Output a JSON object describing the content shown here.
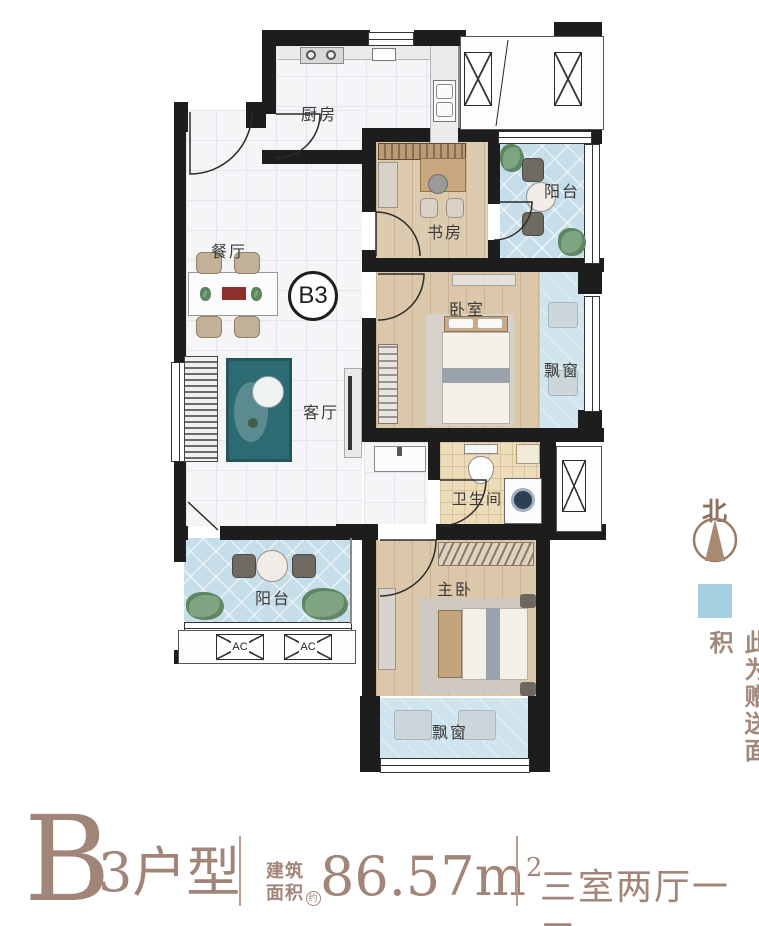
{
  "plan": {
    "badge_label": "B3",
    "labels": {
      "kitchen": "厨房",
      "dining": "餐厅",
      "living": "客厅",
      "study": "书房",
      "balcony_top": "阳台",
      "balcony_bottom": "阳台",
      "bedroom": "卧室",
      "bay_window_right": "飘窗",
      "bay_window_bottom": "飘窗",
      "bathroom": "卫生间",
      "master_bedroom": "主卧",
      "ac": "AC"
    },
    "legend": {
      "north_label": "北",
      "gift_area_text": "此为赠送面积",
      "gift_color": "#a5d0e2",
      "compass_color": "#a88a72"
    }
  },
  "footer": {
    "unit_letter": "B",
    "unit_suffix": "3户型",
    "area_label_top": "建筑",
    "area_label_bottom": "面积",
    "area_approx": "约",
    "area_value": "86.57",
    "area_unit": "m",
    "area_exponent": "2",
    "layout_text": "三室两厅一卫",
    "accent_color": "#a28579"
  }
}
